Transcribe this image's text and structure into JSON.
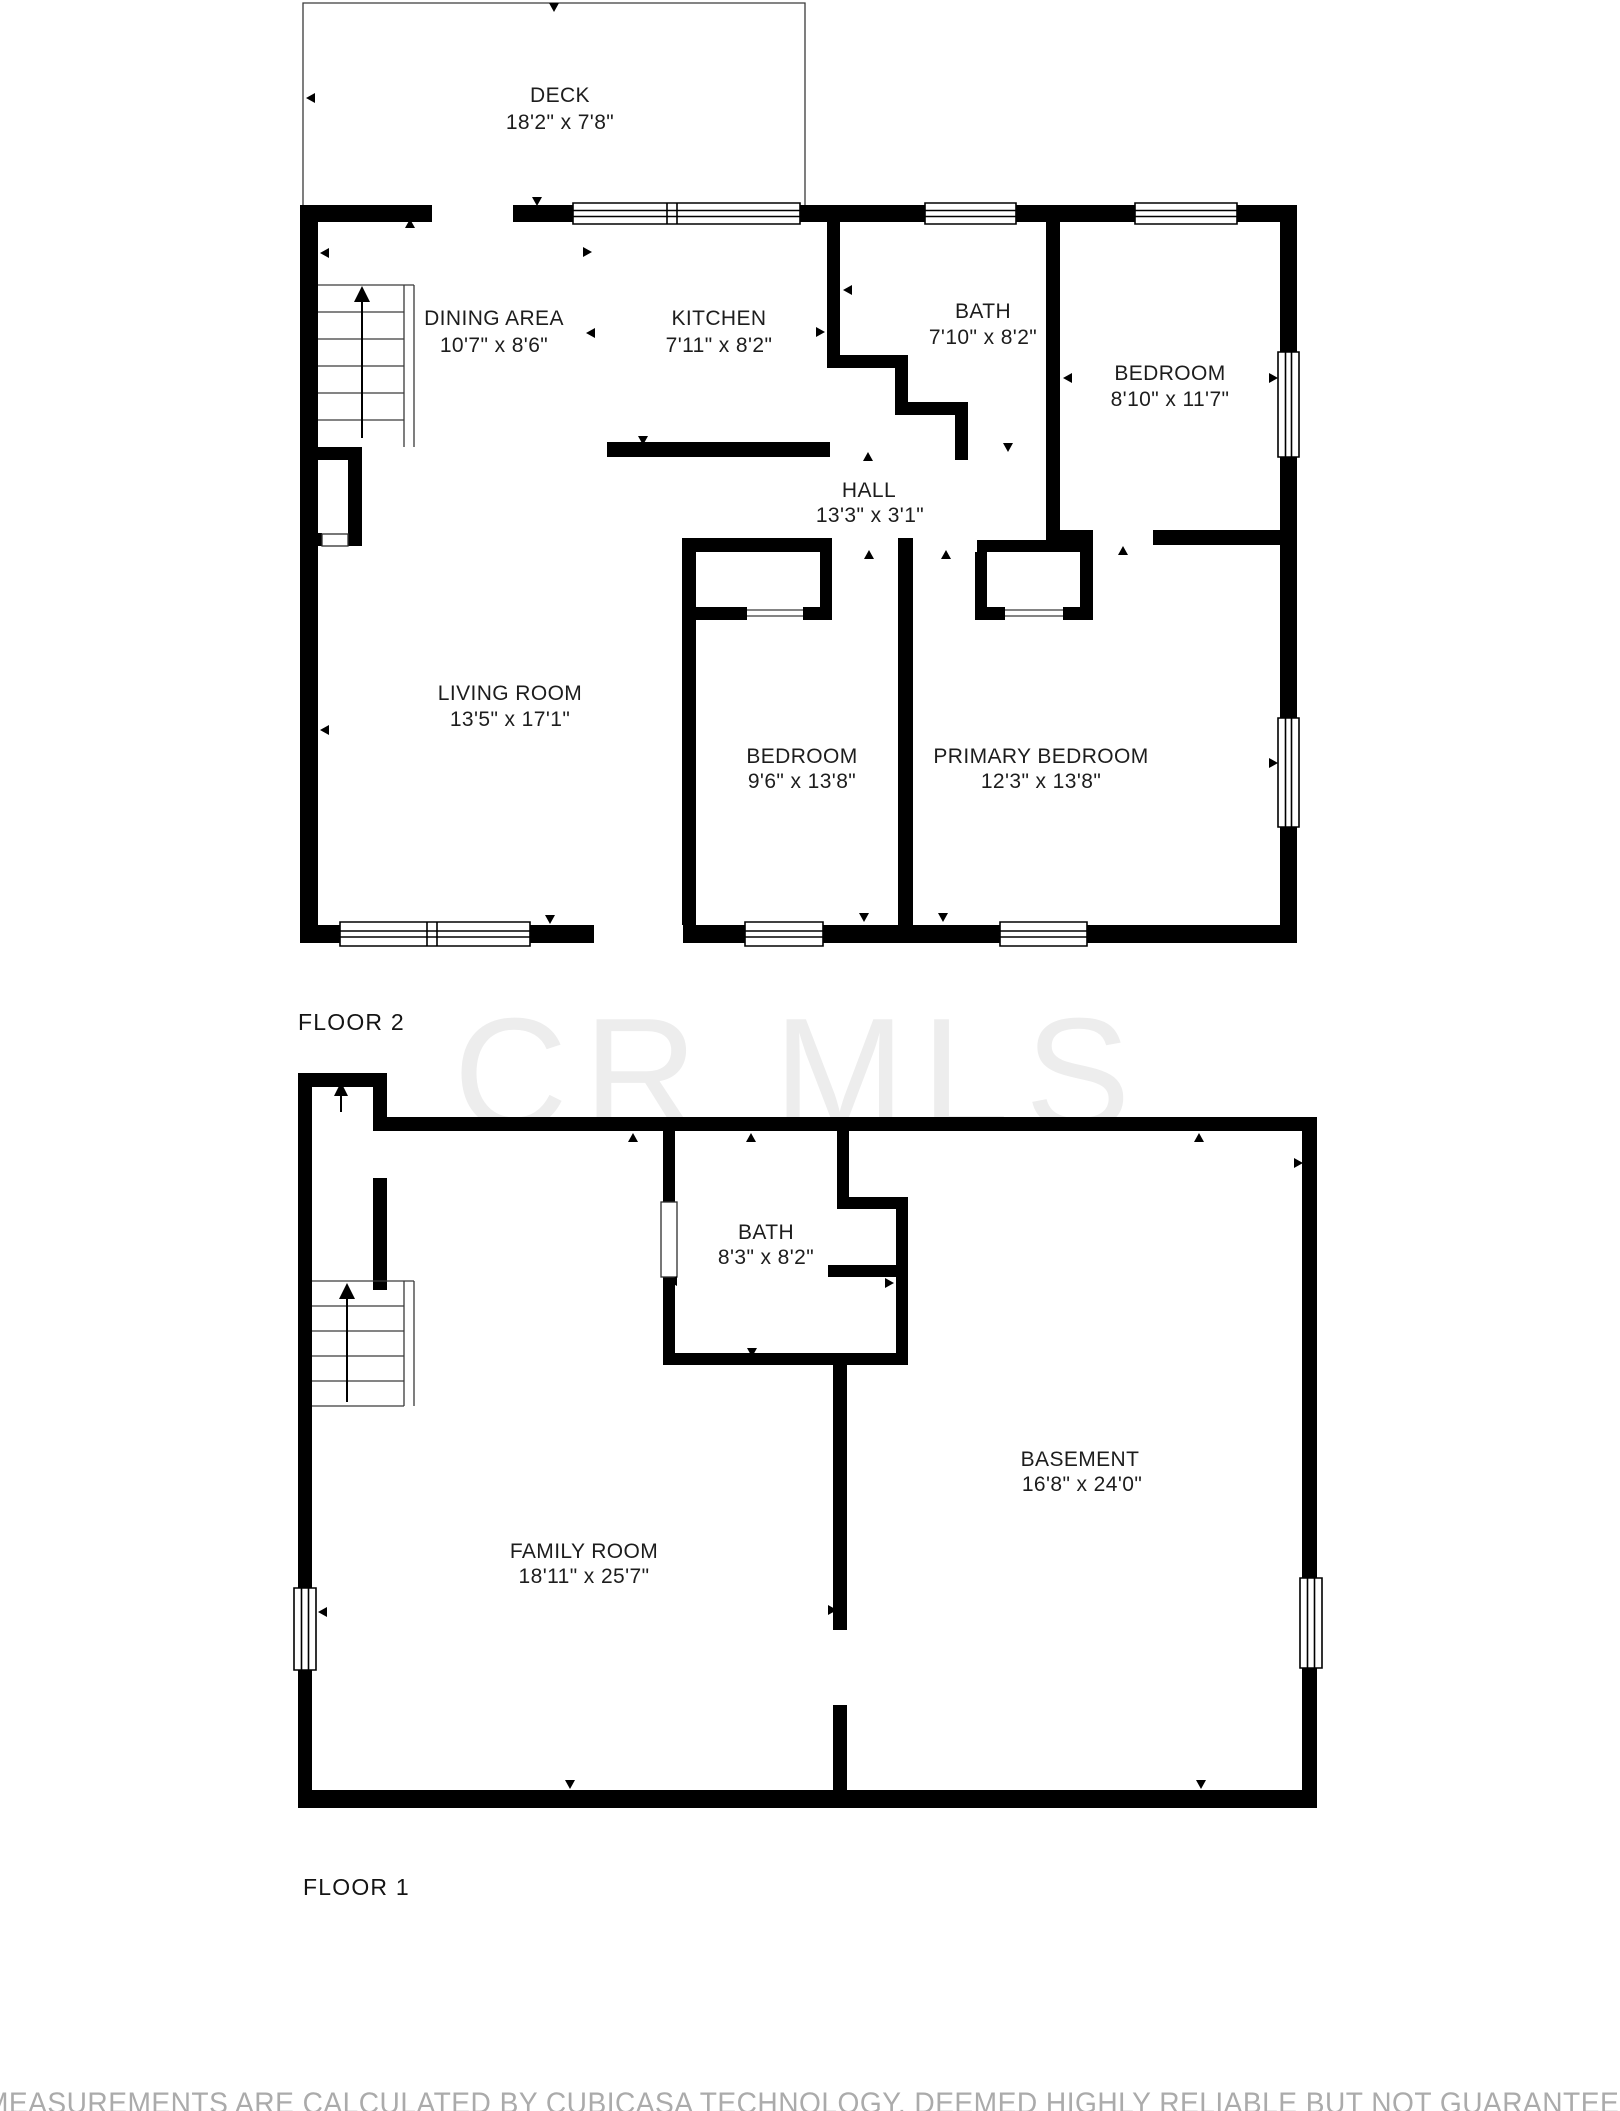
{
  "watermark": {
    "text": "CR MLS",
    "color": "#ededed"
  },
  "disclaimer": {
    "text": "MEASUREMENTS ARE CALCULATED BY CUBICASA TECHNOLOGY, DEEMED HIGHLY RELIABLE BUT NOT GUARANTEED",
    "color": "#ababab"
  },
  "colors": {
    "wall": "#000000",
    "room_label": "#1d1d1d",
    "background": "#ffffff"
  },
  "floor2": {
    "label": "FLOOR 2",
    "rooms": {
      "deck": {
        "name": "DECK",
        "dims": "18'2\" x 7'8\""
      },
      "dining": {
        "name": "DINING AREA",
        "dims": "10'7\" x 8'6\""
      },
      "kitchen": {
        "name": "KITCHEN",
        "dims": "7'11\" x 8'2\""
      },
      "bath": {
        "name": "BATH",
        "dims": "7'10\" x 8'2\""
      },
      "bedroom_top": {
        "name": "BEDROOM",
        "dims": "8'10\" x 11'7\""
      },
      "hall": {
        "name": "HALL",
        "dims": "13'3\" x 3'1\""
      },
      "living": {
        "name": "LIVING ROOM",
        "dims": "13'5\" x 17'1\""
      },
      "bedroom_middle": {
        "name": "BEDROOM",
        "dims": "9'6\" x 13'8\""
      },
      "primary": {
        "name": "PRIMARY BEDROOM",
        "dims": "12'3\" x 13'8\""
      }
    }
  },
  "floor1": {
    "label": "FLOOR 1",
    "rooms": {
      "bath": {
        "name": "BATH",
        "dims": "8'3\" x 8'2\""
      },
      "family": {
        "name": "FAMILY ROOM",
        "dims": "18'11\" x 25'7\""
      },
      "basement": {
        "name": "BASEMENT",
        "dims": "16'8\" x 24'0\""
      }
    }
  }
}
